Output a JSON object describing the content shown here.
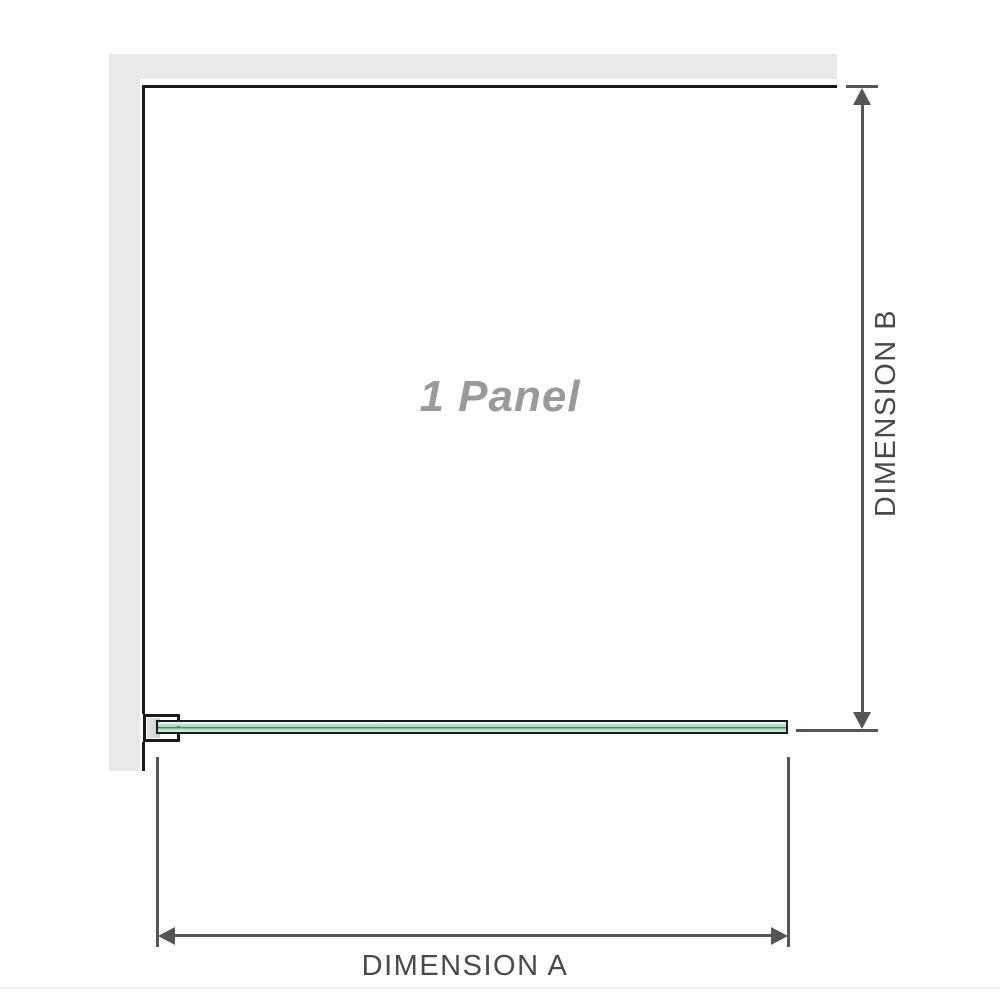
{
  "diagram": {
    "title": "shower panel installation diagram",
    "panel_label": "1 Panel",
    "panel_count": 1,
    "dimension_a_label": "DIMENSION A",
    "dimension_b_label": "DIMENSION B"
  },
  "colors": {
    "background": "#ffffff",
    "wall": "#e9e9e9",
    "panel_outline": "#1a1a1a",
    "dimension_line": "#555555",
    "dimension_text": "#4a4a4a",
    "panel_label_text": "#9a9a9a",
    "glass_light": "#d9f3e5",
    "glass_mid": "#9bd8bb",
    "glass_dark_center": "#335c48",
    "bracket_fill": "#d9d9d9"
  }
}
